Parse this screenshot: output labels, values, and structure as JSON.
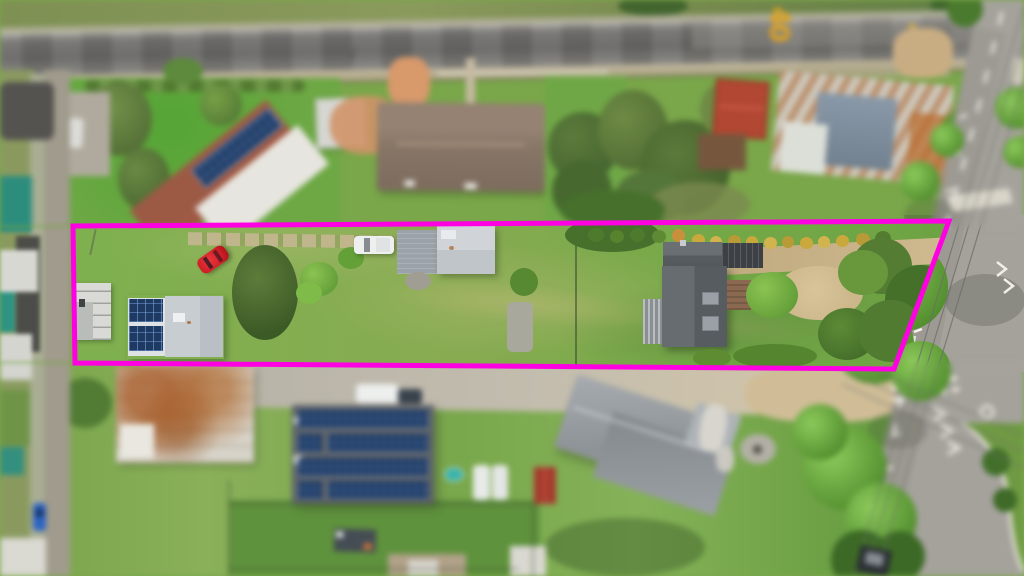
{
  "scene": {
    "type": "aerial-drone-photograph",
    "focus": "long narrow residential block outlined in magenta",
    "road_marking": {
      "text": "40",
      "color": "#E2A41B"
    },
    "boundary": {
      "color": "#FF00E2",
      "points": "73,226 949,221 894,369 75,363",
      "stroke_width": 5
    }
  },
  "palette": {
    "lawn_green": "#7CB14E",
    "asphalt_top_road": "#676664",
    "side_road_grey": "#A5A29C",
    "marking_yellow": "#E2A41B",
    "solar_panel_blue": "#1E3A63",
    "terracotta_roof": "#A35A44",
    "rust_roof": "#A8602F",
    "dark_house_roof": "#5C6164",
    "garage_roof": "#C9CED3",
    "red_car": "#CF1E25",
    "white_vehicle": "#EEF0F0",
    "blue_car": "#2D64C4",
    "teal_roof": "#2C8D7D",
    "magenta_boundary": "#FF00E2"
  },
  "objects": [
    "top-road",
    "speed-40-road-marking",
    "terracotta-roof-house",
    "rooftop-solar-array",
    "white-garden-shed",
    "brown-roof-house",
    "garden-trees",
    "red-roof-shed",
    "rusty-roof-house",
    "outlined-property-lot",
    "left-cottage",
    "solar-shed",
    "red-car",
    "white-ute",
    "grey-garage",
    "dark-roof-house",
    "gravel-driveway",
    "gold-shrub-row",
    "sand-patch",
    "hedge-balls",
    "boundary-trees",
    "concrete-lane",
    "rusty-shed",
    "solar-panel-warehouse",
    "teal-pool",
    "white-vans",
    "red-shed",
    "modern-grey-house",
    "trailer",
    "left-street",
    "blue-car",
    "right-road",
    "road-markings",
    "power-lines",
    "street-trees",
    "grass-verge"
  ]
}
